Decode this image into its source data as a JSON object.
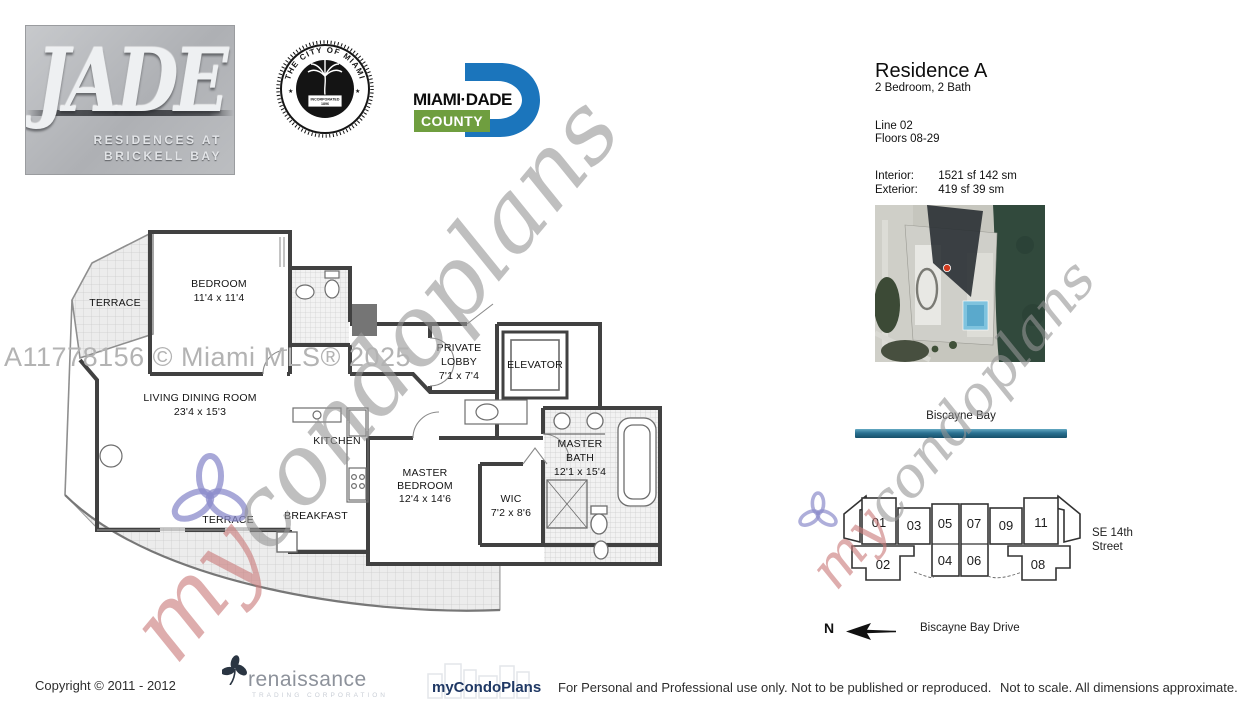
{
  "branding": {
    "jade": {
      "title": "JADE",
      "subtitle1": "RESIDENCES AT",
      "subtitle2": "BRICKELL BAY"
    },
    "city_seal": {
      "arc_top": "THE CITY OF MIAMI",
      "arc_bottom": "FLORIDA",
      "banner1": "INCORPORATED",
      "banner2": "1896",
      "star_left": "★",
      "star_right": "★"
    },
    "miami_dade": {
      "name": "MIAMI·DADE",
      "county": "COUNTY"
    }
  },
  "residence": {
    "title": "Residence A",
    "subtitle": "2 Bedroom, 2 Bath",
    "line": "Line 02",
    "floors": "Floors 08-29",
    "interior_label": "Interior:",
    "interior_value": "1521 sf 142 sm",
    "exterior_label": "Exterior:",
    "exterior_value": "419 sf 39 sm"
  },
  "site_map": {
    "bay_label": "Biscayne Bay",
    "street_line1": "SE 14th",
    "street_line2": "Street",
    "north": "N",
    "drive_label": "Biscayne Bay Drive",
    "units": {
      "u01": "01",
      "u02": "02",
      "u03": "03",
      "u04": "04",
      "u05": "05",
      "u06": "06",
      "u07": "07",
      "u08": "08",
      "u09": "09",
      "u11": "11"
    }
  },
  "floor_plan": {
    "terrace_upper": "TERRACE",
    "terrace_lower": "TERRACE",
    "bedroom_name": "BEDROOM",
    "bedroom_dim": "11'4 x 11'4",
    "living_name": "LIVING DINING ROOM",
    "living_dim": "23'4 x 15'3",
    "kitchen": "KITCHEN",
    "breakfast": "BREAKFAST",
    "master_bed_1": "MASTER",
    "master_bed_2": "BEDROOM",
    "master_bed_dim": "12'4 x 14'6",
    "wic_name": "WIC",
    "wic_dim": "7'2 x 8'6",
    "master_bath_1": "MASTER",
    "master_bath_2": "BATH",
    "master_bath_dim": "12'1 x 15'4",
    "lobby_1": "PRIVATE",
    "lobby_2": "LOBBY",
    "lobby_dim": "7'1 x 7'4",
    "elevator": "ELEVATOR"
  },
  "watermarks": {
    "mls": "A11778156 © Miami MLS® 2025",
    "script_my": "my",
    "script_rest": "condoplans"
  },
  "footer": {
    "copyright": "Copyright © 2011 - 2012",
    "renaissance_name": "renaissance",
    "renaissance_sub": "TRADING CORPORATION",
    "brand": "myCondoPlans",
    "usage": "For Personal and Professional use only.  Not to be published or reproduced.",
    "scale": "Not to scale.  All dimensions approximate."
  },
  "colors": {
    "teal_bar": "#2a7191",
    "dade_blue": "#1b75bc",
    "county_green": "#6f9e3f",
    "brand_navy": "#1f3864",
    "watermark_red": "#c97a7a",
    "watermark_blue": "#8d8dcc"
  }
}
